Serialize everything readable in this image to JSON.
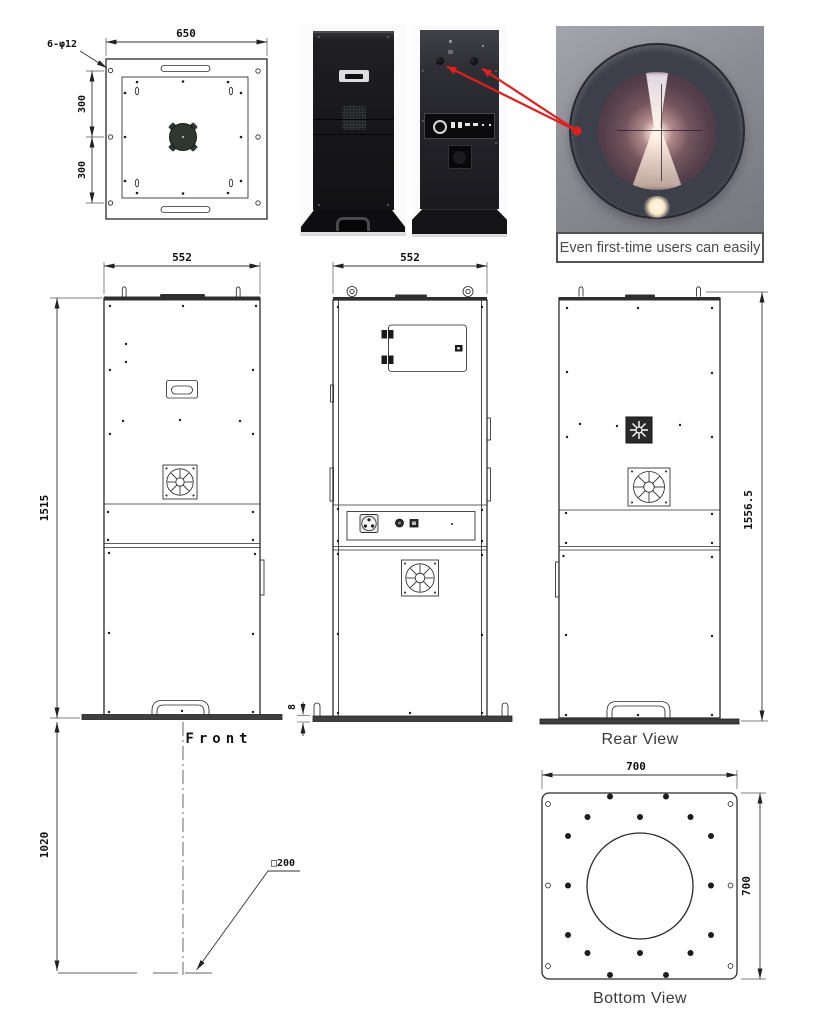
{
  "colors": {
    "drawing_line": "#2b2b2b",
    "dimension_text": "#111111",
    "arrow_red": "#e0201f",
    "kiosk_black": "#17171a",
    "lens_ring": "#3d404a",
    "caption_text": "#4b4b4b"
  },
  "top_view": {
    "width_dim": "650",
    "holes_note": "6-φ12",
    "upper_dim": "300",
    "lower_dim": "300"
  },
  "photos": {
    "lens_caption": "Even first-time users can easily"
  },
  "front_view": {
    "width_dim": "552",
    "height_dim": "1515",
    "label": "Front"
  },
  "open_view": {
    "width_dim": "552",
    "base_thickness_dim": "8"
  },
  "rear_view": {
    "height_dim": "1556.5",
    "label": "Rear View"
  },
  "floor": {
    "height_dim": "1020",
    "square_note": "□200"
  },
  "bottom_view": {
    "width_dim": "700",
    "side_dim": "700",
    "label": "Bottom View"
  }
}
